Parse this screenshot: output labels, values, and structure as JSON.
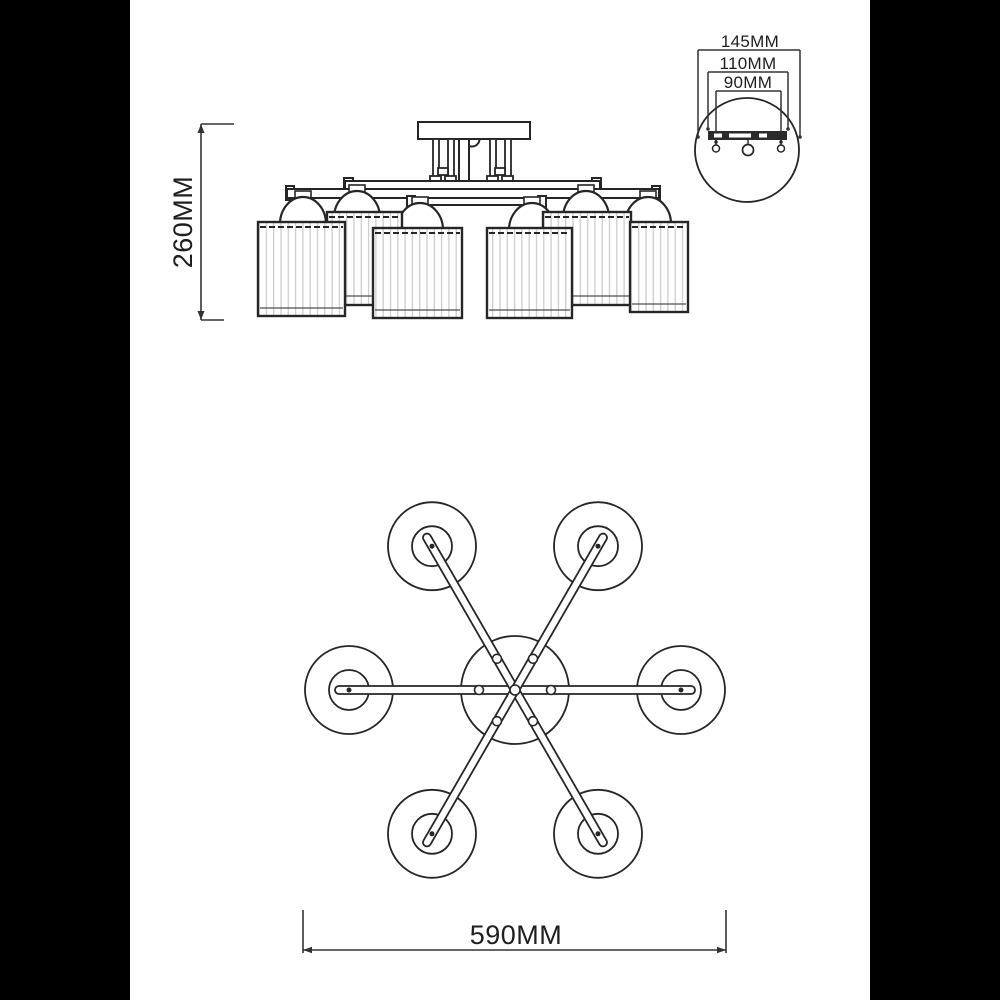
{
  "drawing_type": "ceiling-lamp technical dimension drawing",
  "dimensions": {
    "side_height": "260MM",
    "detail_outer": "145MM",
    "detail_middle": "110MM",
    "detail_inner": "90MM",
    "top_diameter": "590MM"
  },
  "views": {
    "side": "side elevation of 6-shade ceiling lamp",
    "detail": "mounting bracket detail circle",
    "top": "top plan view with 6 radial arms"
  },
  "colors": {
    "line": "#262626",
    "dimension_line": "#333333",
    "pleat": "#c9c9c9",
    "background": "#ffffff",
    "letterbox": "#000000"
  }
}
